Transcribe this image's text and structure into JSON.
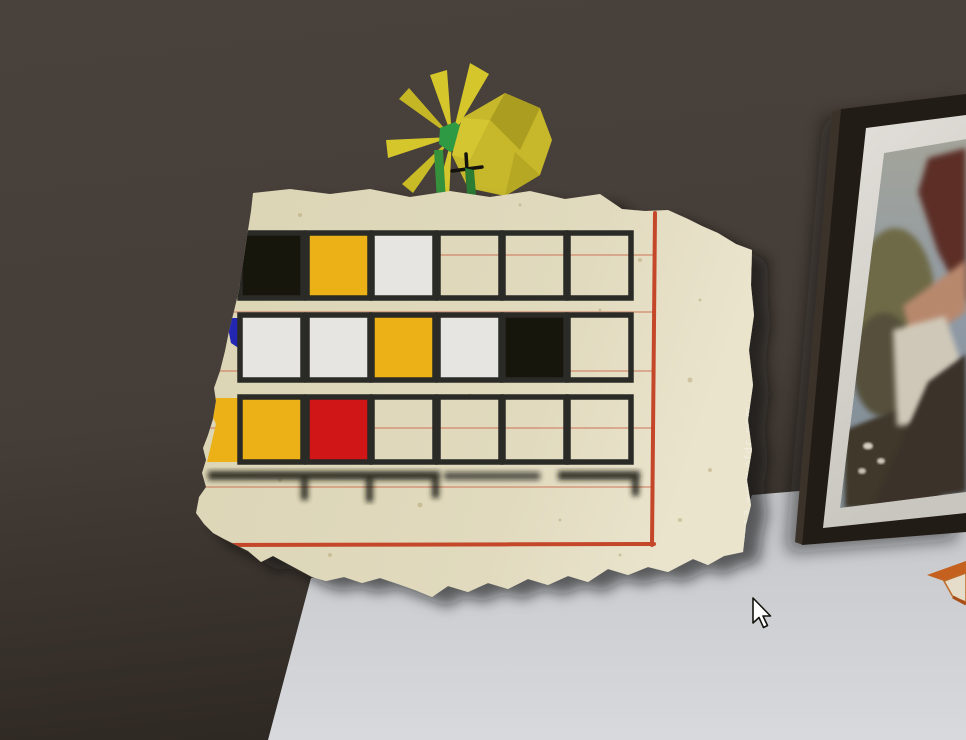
{
  "scene": {
    "type": "3d-escape-room-view",
    "wall_color": "#473f39",
    "wall_dark_corner_color": "#2f2924",
    "table_color": "#cdcfd3"
  },
  "note": {
    "paper_color": "#ded7ba",
    "margin_line_color": "#c23a1e",
    "ruled_line_color": "#c85a40",
    "watermark_text": "E113 www.ofdc.com",
    "grid": {
      "columns": 6,
      "rows": [
        {
          "cells": [
            "black",
            "yellow",
            "white",
            "empty",
            "empty",
            "empty"
          ]
        },
        {
          "cells": [
            "white",
            "white",
            "yellow",
            "white",
            "black",
            "empty"
          ]
        },
        {
          "cells": [
            "yellow",
            "red",
            "empty",
            "empty",
            "empty",
            "empty"
          ]
        }
      ],
      "torn_fragments": [
        {
          "row": 2,
          "color": "blue"
        },
        {
          "row": 3,
          "color": "yellow"
        }
      ],
      "palette": {
        "black": "#17150f",
        "yellow": "#ecb112",
        "white": "#e6e5e2",
        "red": "#d01215",
        "blue": "#2326b2",
        "border": "#2a2a26"
      }
    }
  },
  "flowers": {
    "petal_color": "#d5c72b",
    "petal_dark_color": "#ab9d1f",
    "center_color": "#2e9a43",
    "stem_color": "#35913c",
    "cross_color": "#14120c"
  },
  "picture_frame": {
    "frame_color": "#241e19",
    "mat_color": "#dedbd4",
    "painting_sky_color": "#8e99a5",
    "painting_foliage_color": "#6e6b46",
    "painting_figure_skin_color": "#b8886d",
    "painting_cloth_color": "#cfc8b8",
    "painting_skirt_color": "#3a3129"
  },
  "origami_object": {
    "color": "#c4611f"
  },
  "cursor": {
    "x": 753,
    "y": 598,
    "style": "arrow"
  }
}
